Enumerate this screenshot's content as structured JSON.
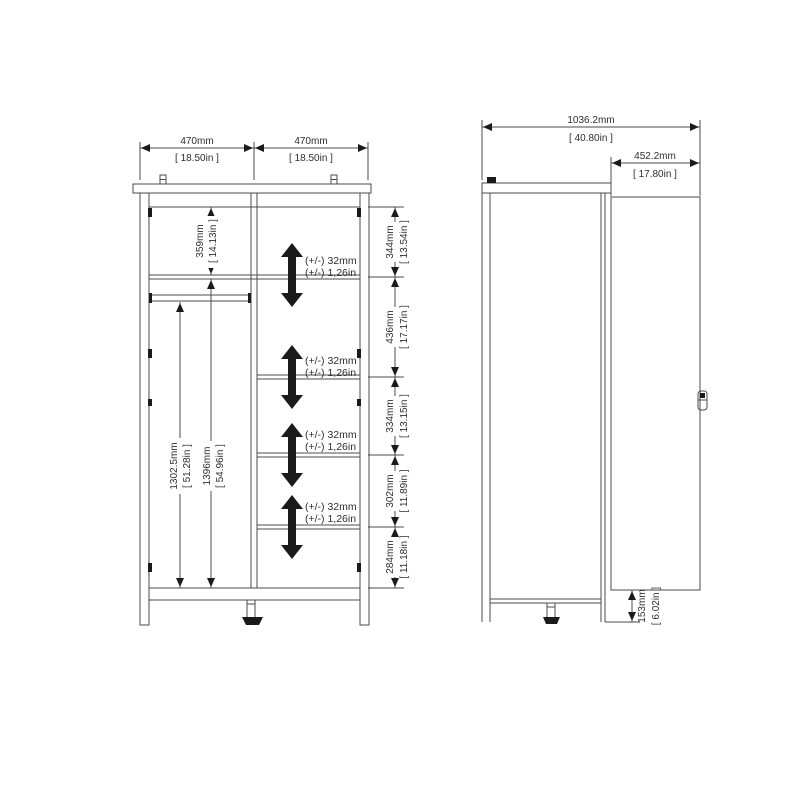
{
  "colors": {
    "line": "#4b4b4b",
    "text": "#2e2e2e",
    "arrow": "#0d0d0d",
    "background": "#ffffff"
  },
  "front_view": {
    "width_dims": [
      {
        "mm": "470mm",
        "inches": "[ 18.50in ]"
      },
      {
        "mm": "470mm",
        "inches": "[ 18.50in ]"
      }
    ],
    "left_section": {
      "top_shelf": {
        "mm": "359mm",
        "inches": "[ 14.13in ]"
      },
      "rod_to_base": {
        "mm": "1302.5mm",
        "inches": "[ 51.28in ]"
      },
      "shelf_to_base": {
        "mm": "1396mm",
        "inches": "[ 54.96in ]"
      }
    },
    "right_section_dims": [
      {
        "mm": "344mm",
        "inches": "[ 13.54in ]"
      },
      {
        "mm": "436mm",
        "inches": "[ 17.17in ]"
      },
      {
        "mm": "334mm",
        "inches": "[ 13.15in ]"
      },
      {
        "mm": "302mm",
        "inches": "[ 11.89in ]"
      },
      {
        "mm": "284mm",
        "inches": "[ 11.18in ]"
      }
    ],
    "shelf_adjustments": [
      {
        "mm": "(+/-) 32mm",
        "inches": "(+/-) 1,26in"
      },
      {
        "mm": "(+/-) 32mm",
        "inches": "(+/-) 1,26in"
      },
      {
        "mm": "(+/-) 32mm",
        "inches": "(+/-) 1,26in"
      },
      {
        "mm": "(+/-) 32mm",
        "inches": "(+/-) 1,26in"
      }
    ]
  },
  "side_view": {
    "total_depth": {
      "mm": "1036.2mm",
      "inches": "[ 40.80in ]"
    },
    "door_panel": {
      "mm": "452.2mm",
      "inches": "[ 17.80in ]"
    },
    "base_height": {
      "mm": "153mm",
      "inches": "[ 6.02in ]"
    }
  }
}
